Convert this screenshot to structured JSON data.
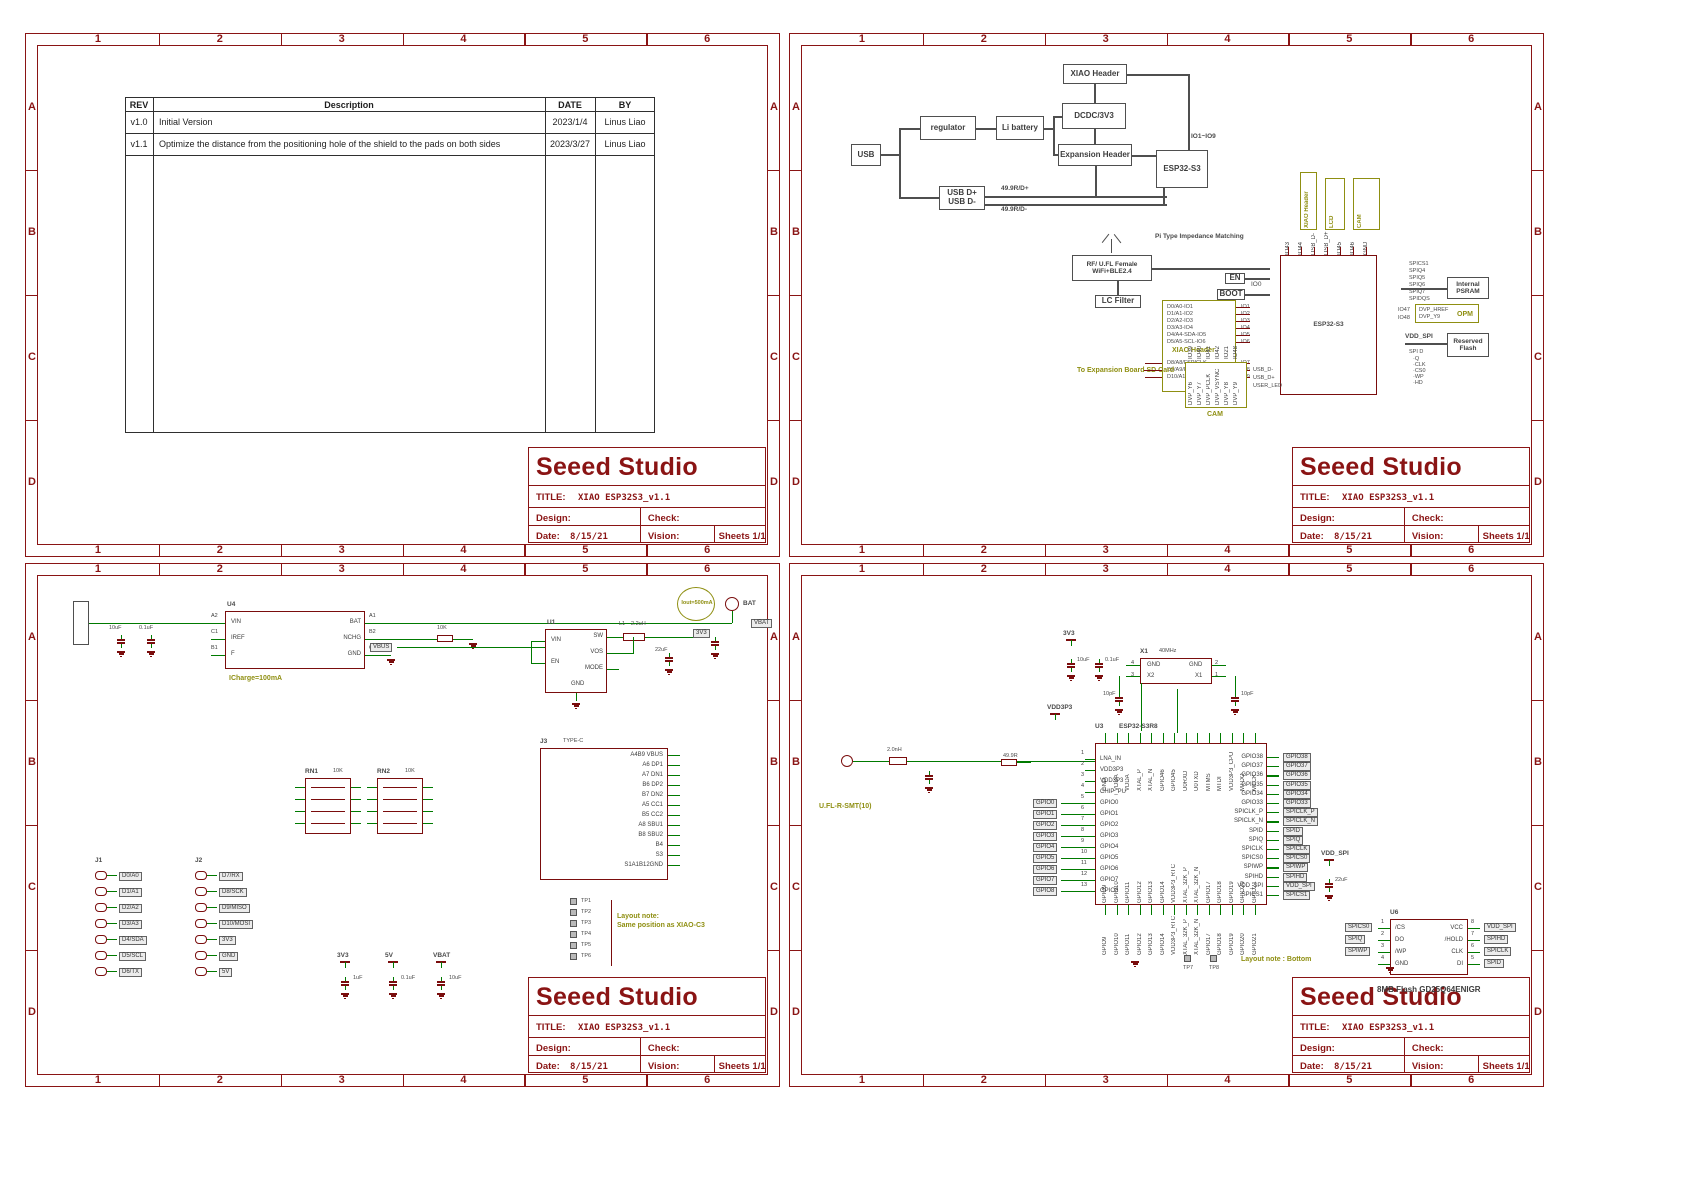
{
  "colors": {
    "frame": "#8a1414",
    "wire": "#007a00",
    "component": "#7a0d0d",
    "highlight": "#8f8f12",
    "block": "#4f4f4f"
  },
  "frame": {
    "cols": [
      "1",
      "2",
      "3",
      "4",
      "5",
      "6"
    ],
    "rows": [
      "A",
      "B",
      "C",
      "D"
    ]
  },
  "title_block": {
    "company": "Seeed Studio",
    "title_label": "TITLE:",
    "title": "XIAO ESP32S3_v1.1",
    "design_label": "Design:",
    "check_label": "Check:",
    "date_label": "Date:",
    "date_value": "8/15/21",
    "vision_label": "Vision:",
    "sheets_label": "Sheets 1/1"
  },
  "sheet1": {
    "revision_table": {
      "headers": [
        "REV",
        "Description",
        "DATE",
        "BY"
      ],
      "rows": [
        {
          "rev": "v1.0",
          "description": "Initial Version",
          "date": "2023/1/4",
          "by": "Linus Liao"
        },
        {
          "rev": "v1.1",
          "description": "Optimize the distance from the positioning hole of the shield to the pads on both sides",
          "date": "2023/3/27",
          "by": "Linus Liao"
        }
      ]
    }
  },
  "sheet2": {
    "block_diagram": {
      "usb": "USB",
      "regulator": "regulator",
      "battery": "Li battery",
      "dcdc": "DCDC/3V3",
      "xiao_header": "XIAO Header",
      "expansion_header": "Expansion Header",
      "esp": "ESP32-S3",
      "usb_dp": "USB D+",
      "usb_dn": "USB D-",
      "r_dp": "49.9R/D+",
      "r_dn": "49.9R/D-",
      "io_range": "IO1~IO9"
    },
    "rf": {
      "ant1": "RF/ U.FL Female",
      "ant2": "WiFi+BLE2.4",
      "pi": "Pi Type Impedance Matching",
      "lc": "LC Filter",
      "en": "EN",
      "boot": "BOOT",
      "io0": "IO0",
      "chip": "ESP32-S3"
    },
    "xiao": {
      "title": "XIAO Header",
      "pins": [
        "D0/A0-IO1",
        "D1/A1-IO2",
        "D2/A2-IO3",
        "D3/A3-IO4",
        "D4/A4-SDA-IO5",
        "D5/A5-SCL-IO6"
      ],
      "ios": [
        "IO1",
        "IO2",
        "IO3",
        "IO4",
        "IO5",
        "IO6"
      ],
      "sd_pins": [
        "D8/A8/FSPICLK",
        "D9/A9/FSPIMISO",
        "D10/A10/FSPIMOSI"
      ],
      "sd_ios": [
        "IO7",
        "IO8",
        "IO9"
      ],
      "sd_note": "To Expansion Board SD Card"
    },
    "top_boxes": [
      {
        "title": "XIAO Header"
      },
      {
        "title": "LCD"
      },
      {
        "title": "CAM"
      }
    ],
    "chip_top_pins": [
      "IO43",
      "IO44",
      "USB_D-",
      "USB_D+",
      "IO45",
      "IO46",
      "GND"
    ],
    "psram": {
      "nets": [
        "SPICS1",
        "SPIQ4",
        "SPIQ5",
        "SPIQ6",
        "SPIQ7",
        "SPIDQS"
      ],
      "box1": "Internal",
      "box2": "PSRAM"
    },
    "opm": {
      "nets": [
        "IO47",
        "IO48"
      ],
      "pins": [
        "DVP_HREF",
        "DVP_Y9"
      ],
      "label": "OPM"
    },
    "rflash": {
      "net": "VDD_SPI",
      "hdr": "SPI D",
      "pins": [
        "·Q",
        "·CLK",
        "·CS0",
        "·WP",
        "·HD"
      ],
      "box1": "Reserved",
      "box2": "Flash"
    },
    "cam": {
      "title": "CAM",
      "pins": [
        "DVP_Y6",
        "DVP_Y7",
        "DVP_PCLK",
        "DVP_VSYNC",
        "DVP_Y8",
        "DVP_Y9"
      ],
      "nets": [
        "IO39",
        "IO40",
        "IO41",
        "IO42",
        "IO21",
        "IO48"
      ],
      "side": [
        "USB_D-",
        "USB_D+",
        "USER_LED"
      ]
    }
  },
  "sheet3": {
    "charger": {
      "ref": "U4",
      "pins_left": [
        "VIN",
        "IREF",
        "F"
      ],
      "nums_left": [
        "A2",
        "C1",
        "B1"
      ],
      "pins_right": [
        "BAT",
        "NCHG",
        "GND"
      ],
      "nums_right": [
        "A1",
        "B2",
        "C2"
      ],
      "note": "ICharge=100mA"
    },
    "bat": {
      "circle": "BAT",
      "tag": "VBAT"
    },
    "dcdc": {
      "ref": "U1",
      "pins_left": [
        "VIN",
        "EN"
      ],
      "pins_right": [
        "SW",
        "VOS",
        "MODE"
      ],
      "pin_gnd": "GND",
      "tag_in": "VBUS",
      "tag_out": "3V3",
      "l": "L1",
      "lval": "2.2uH",
      "iout": "Iout=500mA"
    },
    "headers": {
      "j1": "J1",
      "j1_pins": [
        "D0/A0",
        "D1/A1",
        "D2/A2",
        "D3/A3",
        "D4/SDA",
        "D5/SCL",
        "D6/TX"
      ],
      "j2": "J2",
      "j2_pins": [
        "D7/RX",
        "D8/SCK",
        "D9/MISO",
        "D10/MOSI",
        "3V3",
        "GND",
        "5V"
      ]
    },
    "rn": {
      "r1": "RN1",
      "r2": "RN2",
      "val": "10K"
    },
    "usb": {
      "ref": "J3",
      "part": "TYPE-C",
      "pins": [
        "A4B9 VBUS",
        "A6 DP1",
        "A7 DN1",
        "B6 DP2",
        "B7 DN2",
        "A5 CC1",
        "B5 CC2",
        "A8 SBU1",
        "B8 SBU2",
        "B4",
        "S3",
        "S1A1B12GND"
      ]
    },
    "tps": [
      "TP1",
      "TP2",
      "TP3",
      "TP4",
      "TP5",
      "TP6"
    ],
    "tp_note1": "Layout note:",
    "tp_note2": "Same position as XIAO-C3",
    "values": [
      "10uF",
      "0.1uF",
      "22uF",
      "100K",
      "10K",
      "1uF"
    ],
    "tags": {
      "v5": "5V",
      "vbus": "VBUS",
      "v33": "3V3",
      "vbat": "VBAT"
    }
  },
  "sheet4": {
    "xtal": {
      "ref": "X1",
      "part": "40MHz",
      "g1": "GND",
      "g2": "GND",
      "x2": "X2",
      "x1": "X1",
      "n1": "1",
      "n2": "2",
      "n3": "3",
      "n4": "4",
      "cap": "10pF"
    },
    "ant": {
      "label": "U.FL-R-SMT(10)"
    },
    "esp": {
      "ref": "U3",
      "part": "ESP32-S3R8",
      "left_pins": [
        "LNA_IN",
        "VDD3P3",
        "VDD3P3",
        "CHIP_PU",
        "GPIO0",
        "GPIO1",
        "GPIO2",
        "GPIO3",
        "GPIO4",
        "GPIO5",
        "GPIO6",
        "GPIO7",
        "GPIO8"
      ],
      "left_nums": [
        "1",
        "2",
        "3",
        "4",
        "5",
        "6",
        "7",
        "8",
        "9",
        "10",
        "11",
        "12",
        "13"
      ],
      "top_pins": [
        "GND",
        "VDDA",
        "VDDA",
        "XTAL_P",
        "XTAL_N",
        "GPIO46",
        "GPIO45",
        "U0RXD",
        "U0TXD",
        "MTMS",
        "MTDI",
        "VDD3P3_CPU",
        "MTDO",
        "MTCK"
      ],
      "right_pins": [
        "GPIO38",
        "GPIO37",
        "GPIO36",
        "GPIO35",
        "GPIO34",
        "GPIO33",
        "SPICLK_P",
        "SPICLK_N",
        "SPID",
        "SPIQ",
        "SPICLK",
        "SPICS0",
        "SPIWP",
        "SPIHD",
        "VDD_SPI",
        "SPICS1"
      ],
      "bottom_pins": [
        "GPIO9",
        "GPIO10",
        "GPIO11",
        "GPIO12",
        "GPIO13",
        "GPIO14",
        "VDD3P3_RTC",
        "XTAL_32K_P",
        "XTAL_32K_N",
        "GPIO17",
        "GPIO18",
        "GPIO19",
        "GPIO20",
        "GPIO21"
      ]
    },
    "flash": {
      "ref": "U6",
      "pins_left": [
        "/CS",
        "DO",
        "/WP",
        "GND"
      ],
      "nums_left": [
        "1",
        "2",
        "3",
        "4"
      ],
      "pins_right": [
        "VCC",
        "/HOLD",
        "CLK",
        "DI"
      ],
      "nums_right": [
        "8",
        "7",
        "6",
        "5"
      ],
      "label": "8MB Flash  GD25Q64ENIGR"
    },
    "tps": [
      "TP7",
      "TP8"
    ],
    "tp_note": "Layout note : Bottom",
    "tags": {
      "v33": "3V3",
      "vspi": "VDD_SPI",
      "gnd": "GND",
      "vdd": "VDD3P3"
    },
    "values": [
      "10uF",
      "0.1uF",
      "22uF",
      "10K",
      "49.9R",
      "10pF",
      "1uH",
      "2.0nH"
    ]
  }
}
